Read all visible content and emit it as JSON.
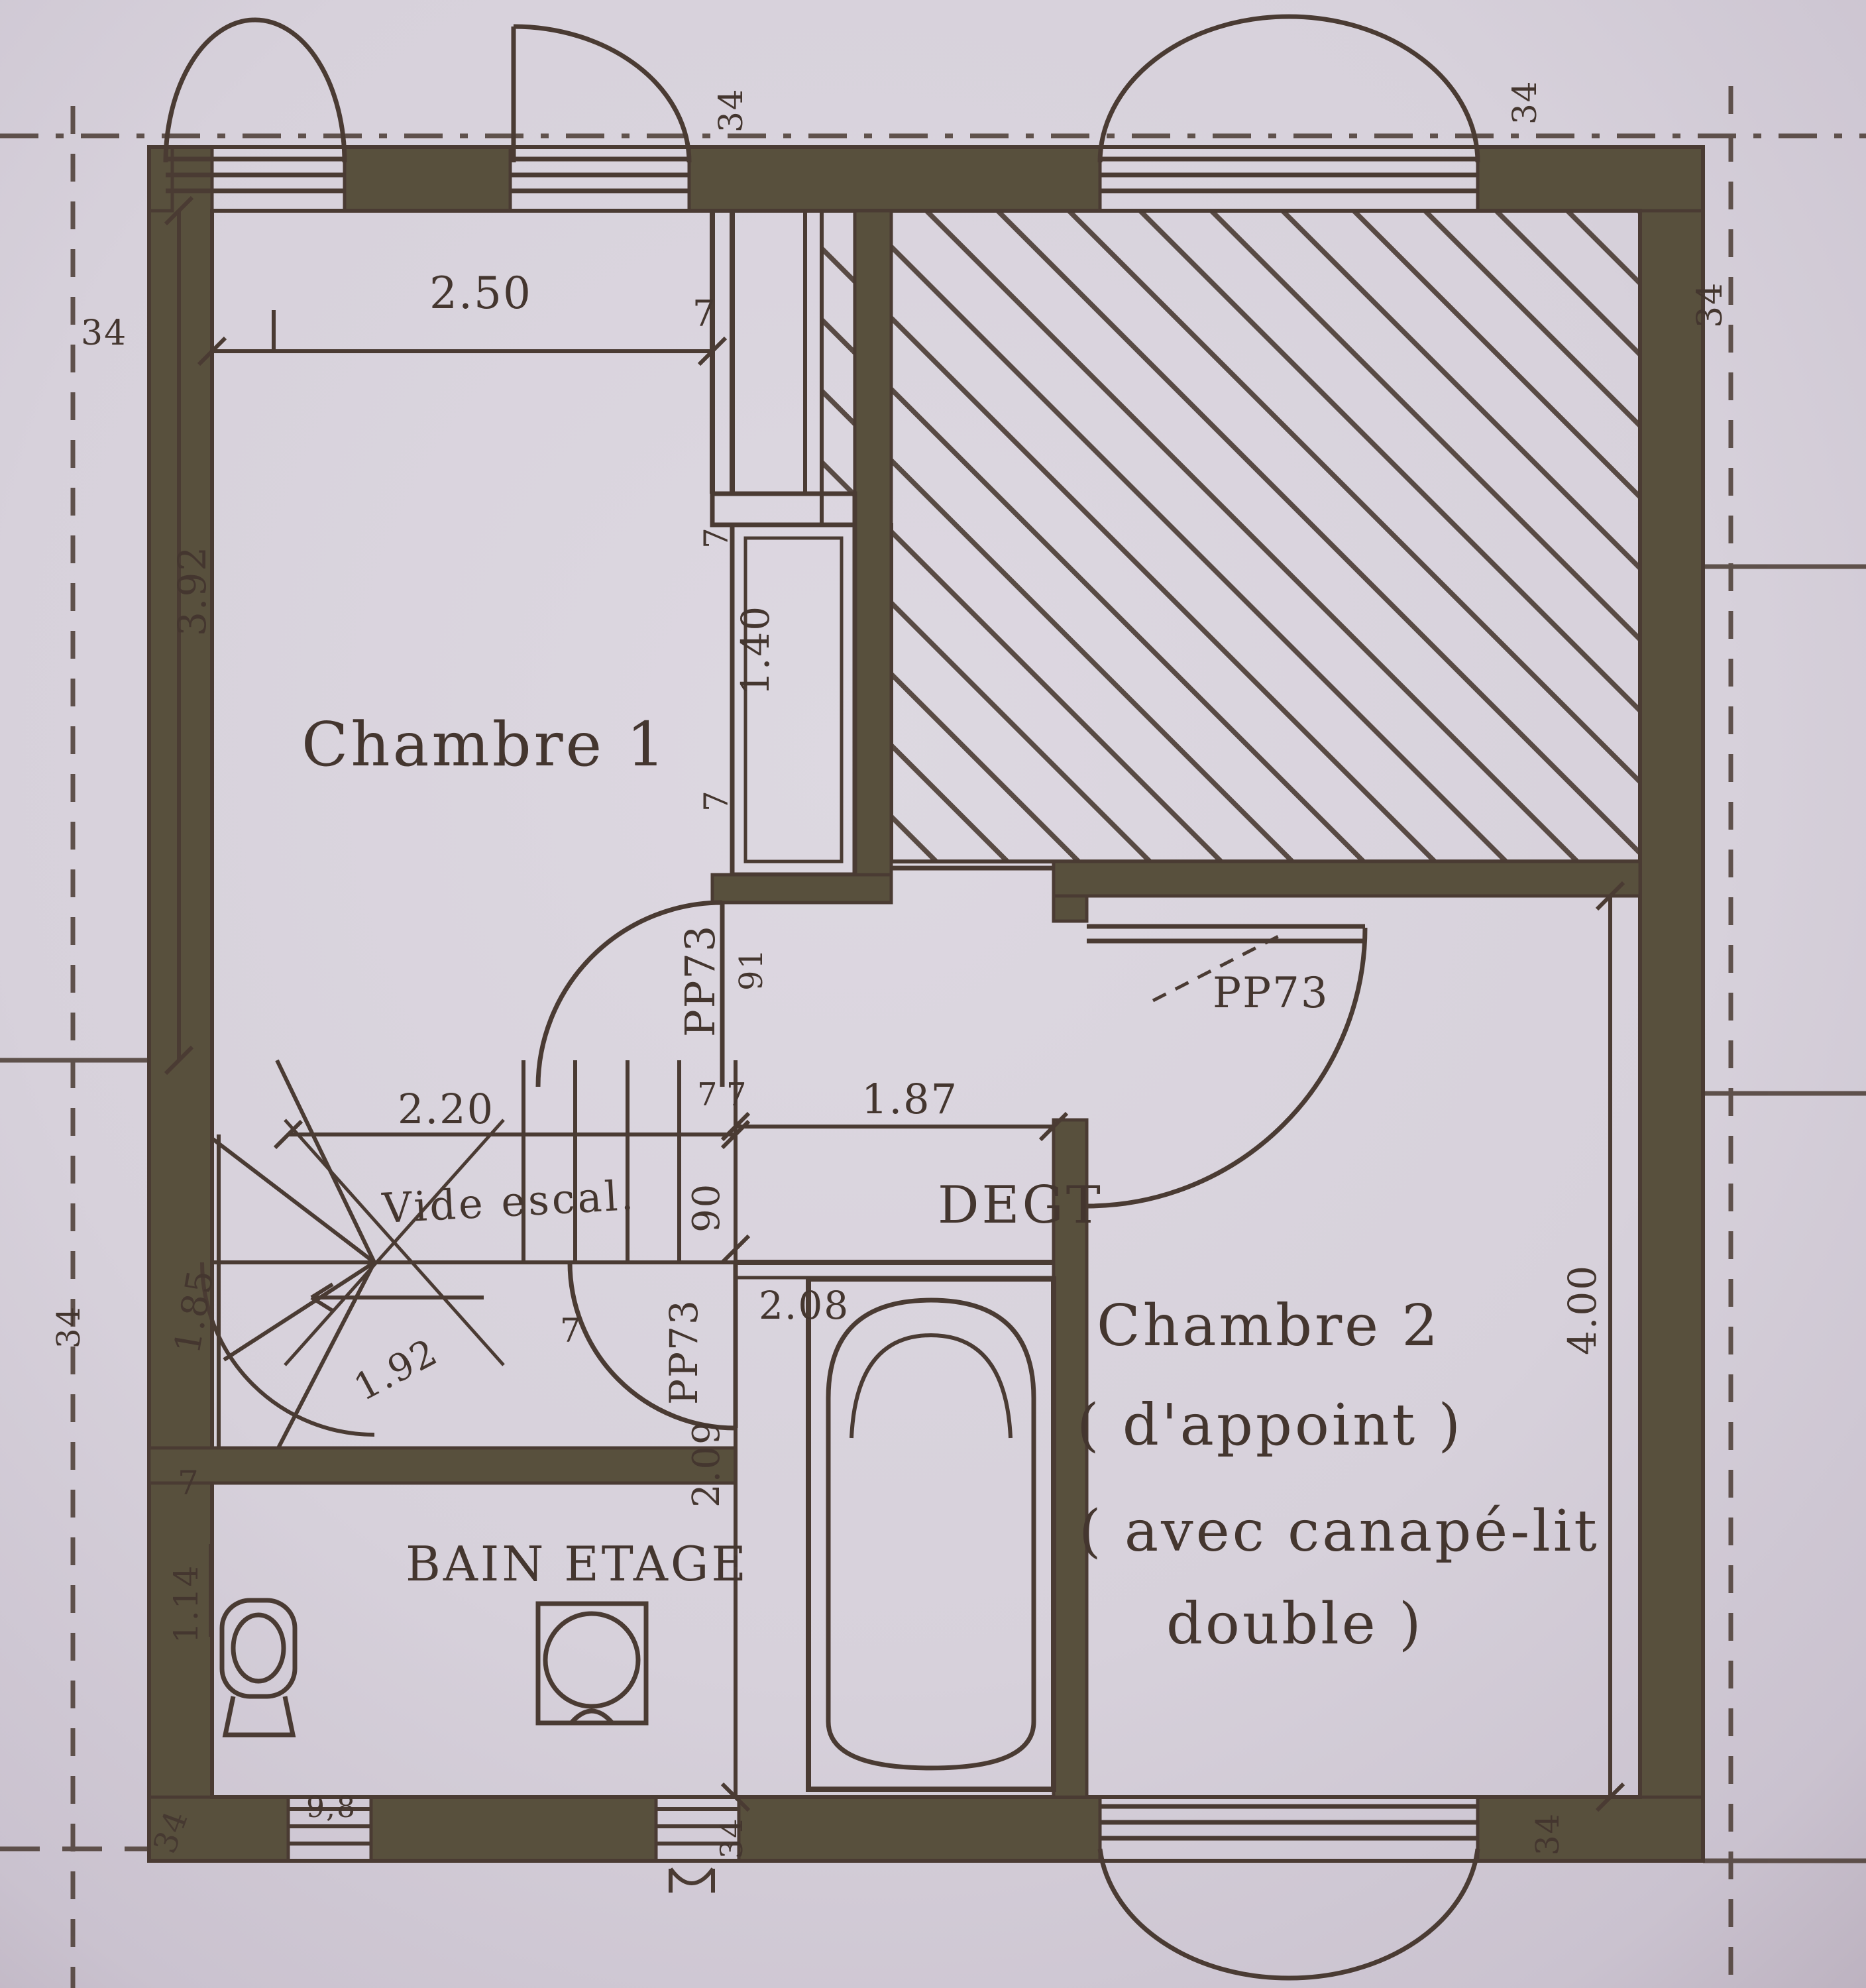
{
  "document": {
    "kind": "scanned floor plan",
    "floor": "étage (upper floor)"
  },
  "colors": {
    "paper": "#d9d3dd",
    "paper_edge": "#bfb5c3",
    "ink": "#4a3b33",
    "wall_fill": "#58503d"
  },
  "rooms": {
    "chambre1": {
      "label": "Chambre 1"
    },
    "chambre2": {
      "label": "Chambre 2",
      "sub1": "( d'appoint )",
      "sub2": "( avec canapé-lit",
      "sub3": "double )"
    },
    "bathroom": {
      "label": "BAIN ETAGE"
    },
    "landing": {
      "label": "DEGT"
    },
    "stair_void": {
      "label": "Vide escal."
    }
  },
  "doors": {
    "chambre1_code": "PP73",
    "chambre1_width": "91",
    "chambre2_code": "PP73",
    "bathroom_code": "PP73"
  },
  "dimensions": {
    "chambre1_width": "2.50",
    "chambre1_length": "3.92",
    "closet_recess": "1.40",
    "landing_width": "1.87",
    "landing_depth": "90",
    "stairs_width": "2.20",
    "stairs_left": "1.85",
    "stairs_diag": "1.92",
    "bath_north": "2.08",
    "bath_length": "2.09",
    "chambre2_length": "4.00",
    "wc_side": "1.14",
    "small_window": "9,8",
    "wall_thickness": "7"
  },
  "wall_markers": {
    "value": "34"
  }
}
